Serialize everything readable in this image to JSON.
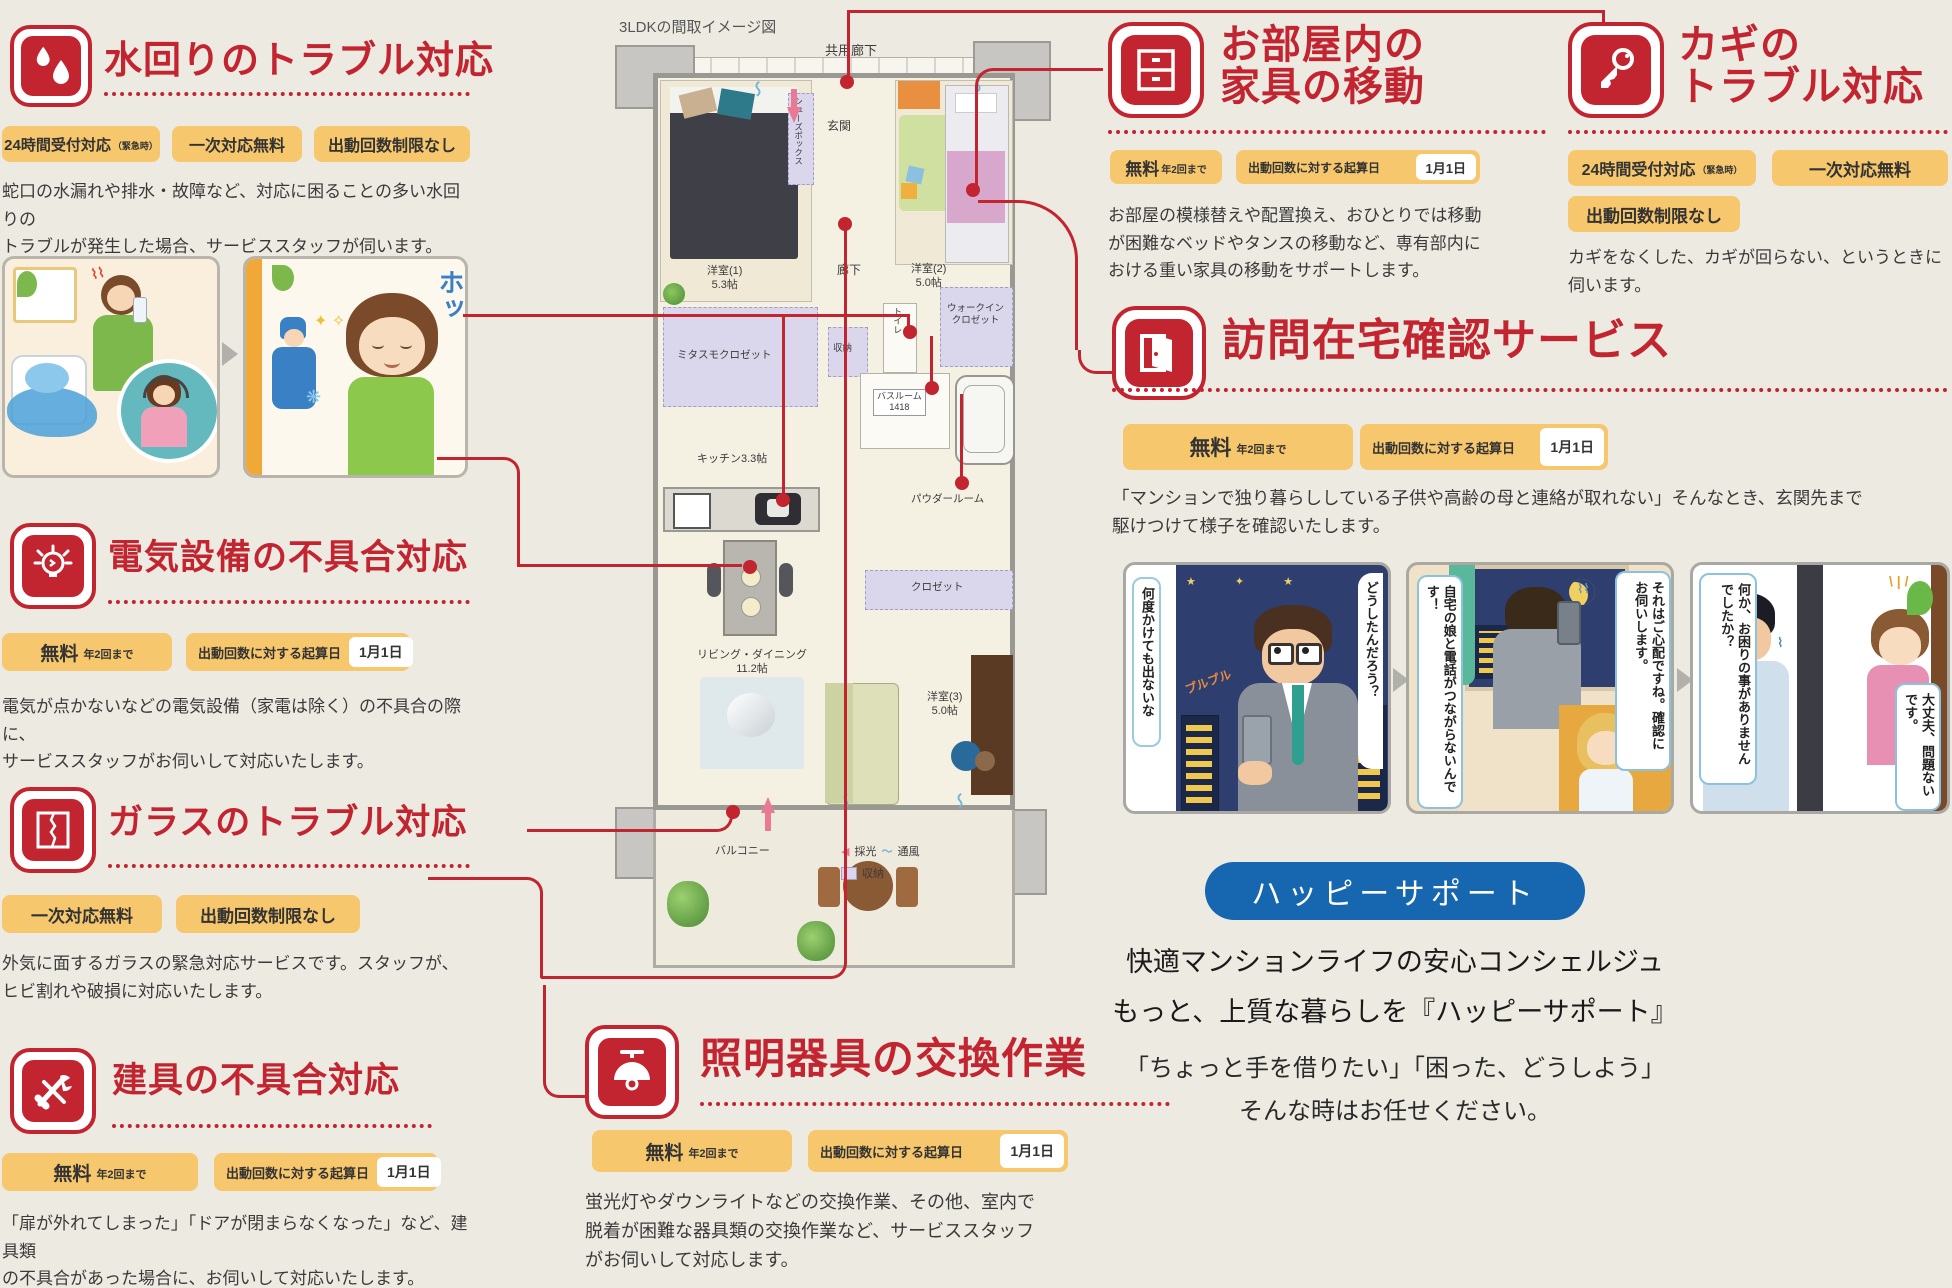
{
  "colors": {
    "accent_red": "#c22430",
    "badge_orange": "#f6c76d",
    "banner_blue": "#1766b0",
    "bg": "#edeae2"
  },
  "floorplan": {
    "title": "3LDKの間取イメージ図",
    "labels": {
      "common_corridor": "共用廊下",
      "entrance": "玄関",
      "shoes_box": "シューズボックス",
      "room1": "洋室(1)",
      "room1_size": "5.3帖",
      "room2": "洋室(2)",
      "room2_size": "5.0帖",
      "corridor": "廊下",
      "toilet": "トイレ",
      "mitasumo_closet": "ミタスモクロゼット",
      "walkin1": "ウォークイン",
      "walkin2": "クロゼット",
      "storage": "収納",
      "bathroom": "バスルーム",
      "bathroom_size": "1418",
      "kitchen": "キッチン3.3帖",
      "powder_room": "パウダールーム",
      "closet": "クロゼット",
      "living": "リビング・ダイニング",
      "living_size": "11.2帖",
      "room3": "洋室(3)",
      "room3_size": "5.0帖",
      "balcony": "バルコニー"
    },
    "legend": {
      "light": "採光",
      "wind": "通風",
      "storage": "収納"
    }
  },
  "services": {
    "water": {
      "title": "水回りのトラブル対応",
      "badge1_main": "24時間受付対応",
      "badge1_sub": "（緊急時）",
      "badge2": "一次対応無料",
      "badge3": "出動回数制限なし",
      "desc1": "蛇口の水漏れや排水・故障など、対応に困ることの多い水回りの",
      "desc2": "トラブルが発生した場合、サービススタッフが伺います。",
      "relief_text": "ホッ"
    },
    "electric": {
      "title": "電気設備の不具合対応",
      "free_main": "無料",
      "free_sub": "年2回まで",
      "date_label": "出動回数に対する起算日",
      "date_value": "1月1日",
      "desc1": "電気が点かないなどの電気設備（家電は除く）の不具合の際に、",
      "desc2": "サービススタッフがお伺いして対応いたします。"
    },
    "glass": {
      "title": "ガラスのトラブル対応",
      "badge1": "一次対応無料",
      "badge2": "出動回数制限なし",
      "desc1": "外気に面するガラスの緊急対応サービスです。スタッフが、",
      "desc2": "ヒビ割れや破損に対応いたします。"
    },
    "fittings": {
      "title": "建具の不具合対応",
      "free_main": "無料",
      "free_sub": "年2回まで",
      "date_label": "出動回数に対する起算日",
      "date_value": "1月1日",
      "desc1": "「扉が外れてしまった」「ドアが閉まらなくなった」など、建具類",
      "desc2": "の不具合があった場合に、お伺いして対応いたします。"
    },
    "lighting": {
      "title": "照明器具の交換作業",
      "free_main": "無料",
      "free_sub": "年2回まで",
      "date_label": "出動回数に対する起算日",
      "date_value": "1月1日",
      "desc1": "蛍光灯やダウンライトなどの交換作業、その他、室内で",
      "desc2": "脱着が困難な器具類の交換作業など、サービススタッフ",
      "desc3": "がお伺いして対応します。"
    },
    "furniture": {
      "title1": "お部屋内の",
      "title2": "家具の移動",
      "free_main": "無料",
      "free_sub": "年2回まで",
      "date_label": "出動回数に対する起算日",
      "date_value": "1月1日",
      "desc1": "お部屋の模様替えや配置換え、おひとりでは移動",
      "desc2": "が困難なベッドやタンスの移動など、専有部内に",
      "desc3": "おける重い家具の移動をサポートします。"
    },
    "key": {
      "title1": "カギの",
      "title2": "トラブル対応",
      "badge1_main": "24時間受付対応",
      "badge1_sub": "（緊急時）",
      "badge2": "一次対応無料",
      "badge3": "出動回数制限なし",
      "desc1": "カギをなくした、カギが回らない、というときに",
      "desc2": "伺います。"
    },
    "visit": {
      "title": "訪問在宅確認サービス",
      "free_main": "無料",
      "free_sub": "年2回まで",
      "date_label": "出動回数に対する起算日",
      "date_value": "1月1日",
      "desc1": "「マンションで独り暮らししている子供や高齢の母と連絡が取れない」そんなとき、玄関先まで",
      "desc2": "駆けつけて様子を確認いたします。",
      "panel1_left": "何度かけても出ないな",
      "panel1_right": "どうしたんだろう？",
      "panel2_left": "自宅の娘と電話がつながらないんです！",
      "panel2_right": "それはご心配ですね。確認にお伺いします。",
      "panel3_left": "何か、お困りの事がありませんでしたか？",
      "panel3_right": "大丈夫、問題ないです。"
    }
  },
  "happy_support": {
    "banner": "ハッピーサポート",
    "line1": "快適マンションライフの安心コンシェルジュ",
    "line2": "もっと、上質な暮らしを『ハッピーサポート』",
    "line3": "「ちょっと手を借りたい」「困った、どうしよう」",
    "line4": "そんな時はお任せください。"
  }
}
